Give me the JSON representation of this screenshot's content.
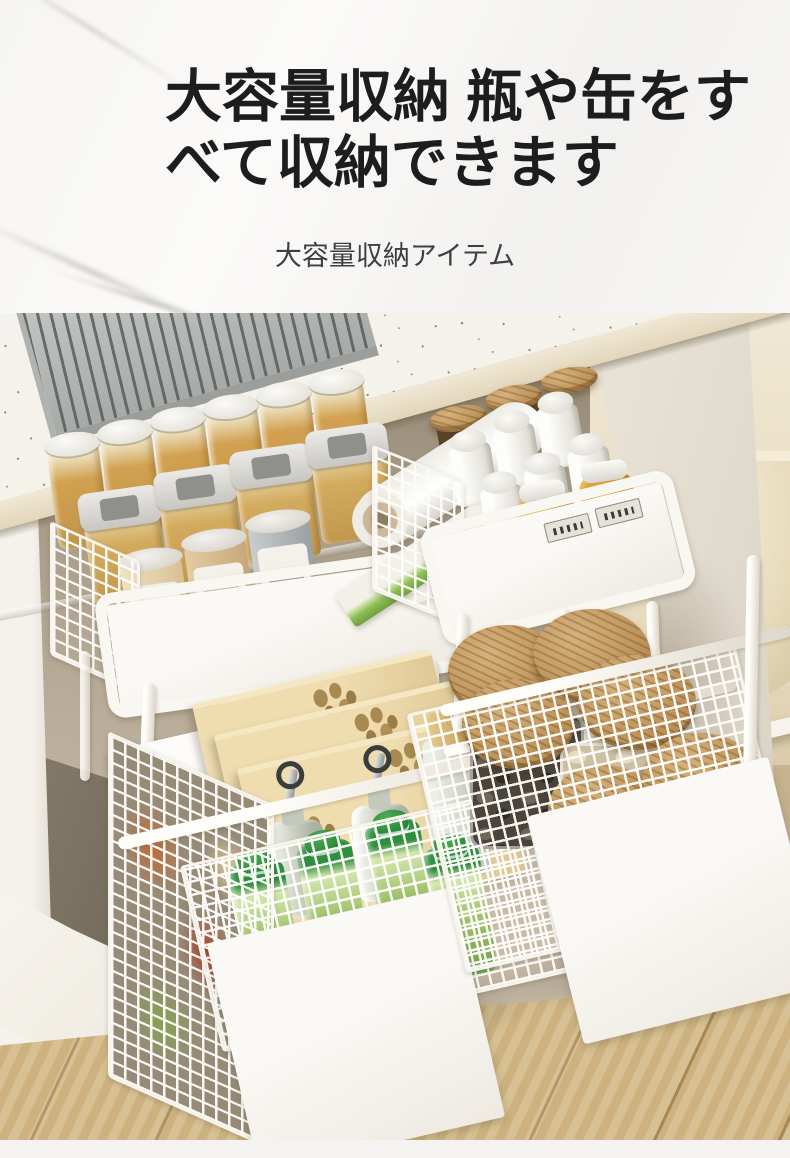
{
  "header": {
    "title_line1": "大容量収納 瓶や缶をす",
    "title_line2": "べて収納できます",
    "subtitle": "大容量収納アイテム"
  },
  "colors": {
    "title": "#1d1d1d",
    "subtitle": "#3f3f3f",
    "header_bg": "#f6f5f3",
    "counter_speckle_base": "#f4f2eb",
    "counter_edge": "#e2d6ba",
    "cabinet_interior": "#b3a794",
    "rack_metal": "#9a9c99",
    "frame_white": "#f7f4ee",
    "kraft_box": "#e4cfa0",
    "wood_lid": "#b98f55",
    "green_bottle": "#6f9c4e",
    "amber_jar": "#d2a050",
    "wood_floor": "#d3b987",
    "footer_strip": "#f4f3f1"
  }
}
